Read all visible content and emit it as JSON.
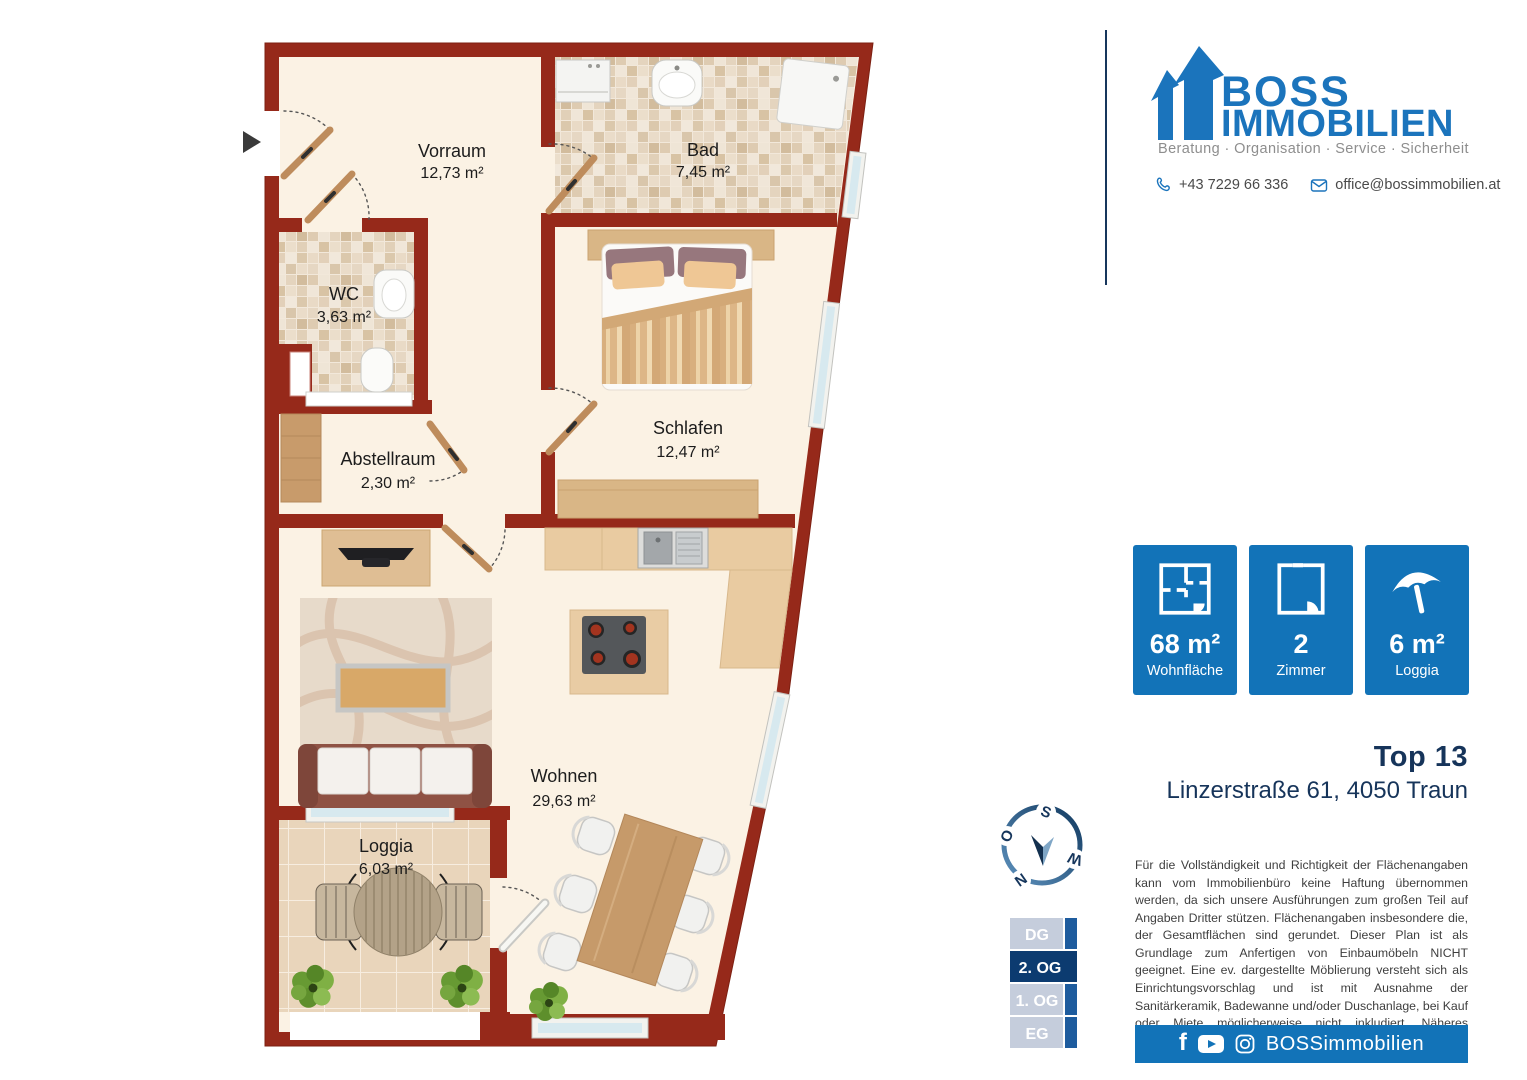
{
  "branding": {
    "boss": "BOSS",
    "immobilien": "IMMOBILIEN",
    "tagline": "Beratung · Organisation · Service · Sicherheit",
    "phone": "+43 7229 66 336",
    "email": "office@bossimmobilien.at"
  },
  "listing": {
    "title": "Top 13",
    "address": "Linzerstraße 61, 4050 Traun"
  },
  "stats": [
    {
      "value": "68 m²",
      "label": "Wohnfläche",
      "icon": "floorplan-icon"
    },
    {
      "value": "2",
      "label": "Zimmer",
      "icon": "room-icon"
    },
    {
      "value": "6 m²",
      "label": "Loggia",
      "icon": "umbrella-icon"
    }
  ],
  "floors": [
    {
      "label": "DG",
      "active": false
    },
    {
      "label": "2. OG",
      "active": true
    },
    {
      "label": "1. OG",
      "active": false
    },
    {
      "label": "EG",
      "active": false
    }
  ],
  "floorplan": {
    "rooms": [
      {
        "name": "Vorraum",
        "area": "12,73 m²"
      },
      {
        "name": "Bad",
        "area": "7,45 m²"
      },
      {
        "name": "WC",
        "area": "3,63 m²"
      },
      {
        "name": "Abstellraum",
        "area": "2,30 m²"
      },
      {
        "name": "Schlafen",
        "area": "12,47 m²"
      },
      {
        "name": "Wohnen",
        "area": "29,63 m²"
      },
      {
        "name": "Loggia",
        "area": "6,03 m²"
      }
    ],
    "compass": {
      "n": "N",
      "o": "O",
      "s": "S",
      "w": "W"
    }
  },
  "disclaimer": {
    "text": "Für die Vollständigkeit und Richtigkeit der Flächenangaben kann vom Immobilienbüro keine Haftung übernommen werden, da sich unsere Ausführungen zum großen Teil auf Angaben Dritter stützen. Flächenangaben insbesondere die, der Gesamtflächen sind gerundet. Dieser Plan ist als Grundlage zum Anfertigen von Einbaumöbeln NICHT geeignet. Eine ev. dargestellte Möblierung versteht sich als Einrichtungsvorschlag und ist mit Ausnahme der Sanitärkeramik, Badewanne und/oder Duschanlage, bei Kauf oder Miete möglicherweise nicht inkludiert. Näheres entnehmen Sie bitte aus dem Inserat."
  },
  "social": {
    "handle": "BOSSimmobilien"
  },
  "colors": {
    "brand_blue": "#1273b8",
    "navy": "#16365c",
    "wall_red": "#96291a"
  }
}
